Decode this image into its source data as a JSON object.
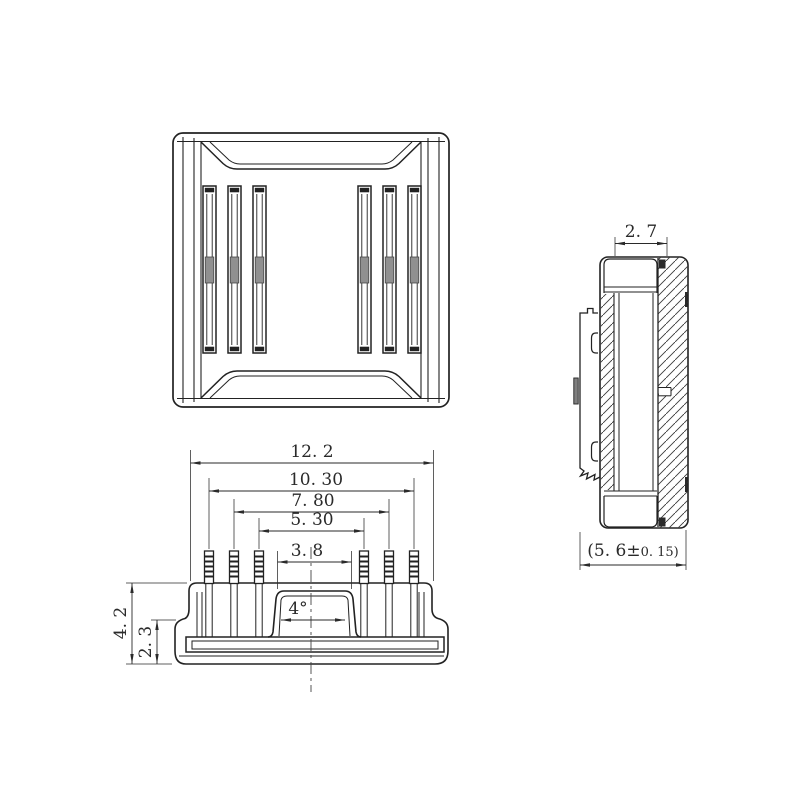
{
  "palette": {
    "background": "#ffffff",
    "line_color": "#222222",
    "dim_color": "#2a2a2a",
    "slot_contact_gray": "#909090",
    "tab_gray": "#808080"
  },
  "dims": {
    "overall_width": "12. 2",
    "pin_span_outer": "10. 30",
    "pin_span_middle": "7. 80",
    "pin_span_inner": "5. 30",
    "boss_width": "3. 8",
    "draft_angle": "4°",
    "overall_height": "4. 2",
    "base_height": "2. 3",
    "top_width": "2. 7",
    "depth_main": "(5. 6±",
    "depth_tol": "0. 15)"
  }
}
